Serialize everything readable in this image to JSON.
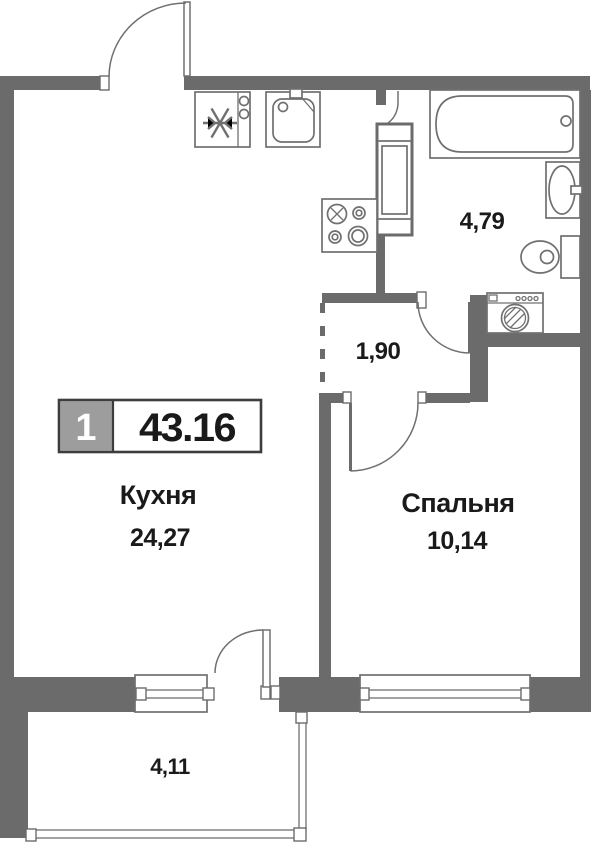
{
  "colors": {
    "bg": "#ffffff",
    "wall": "#6b6b6b",
    "fixture": "#707070",
    "text": "#1a1a1a",
    "badge-gray": "#9d9d9d",
    "badge-border": "#3d3d3d"
  },
  "badge": {
    "number": "1",
    "total_area": "43.16"
  },
  "rooms": {
    "kitchen": {
      "name": "Кухня",
      "area": "24,27"
    },
    "bedroom": {
      "name": "Спальня",
      "area": "10,14"
    },
    "bathroom": {
      "area": "4,79"
    },
    "hallway": {
      "area": "1,90"
    },
    "balcony": {
      "area": "4,11"
    }
  },
  "icons": [
    "fridge-icon",
    "kitchen-sink-icon",
    "stove-icon",
    "vent-shaft-icon",
    "bathtub-icon",
    "washbasin-icon",
    "toilet-icon",
    "washing-machine-icon",
    "entrance-door-icon",
    "bathroom-door-icon",
    "bedroom-door-icon",
    "balcony-door-icon",
    "window-icon",
    "balcony-glazing-icon"
  ]
}
